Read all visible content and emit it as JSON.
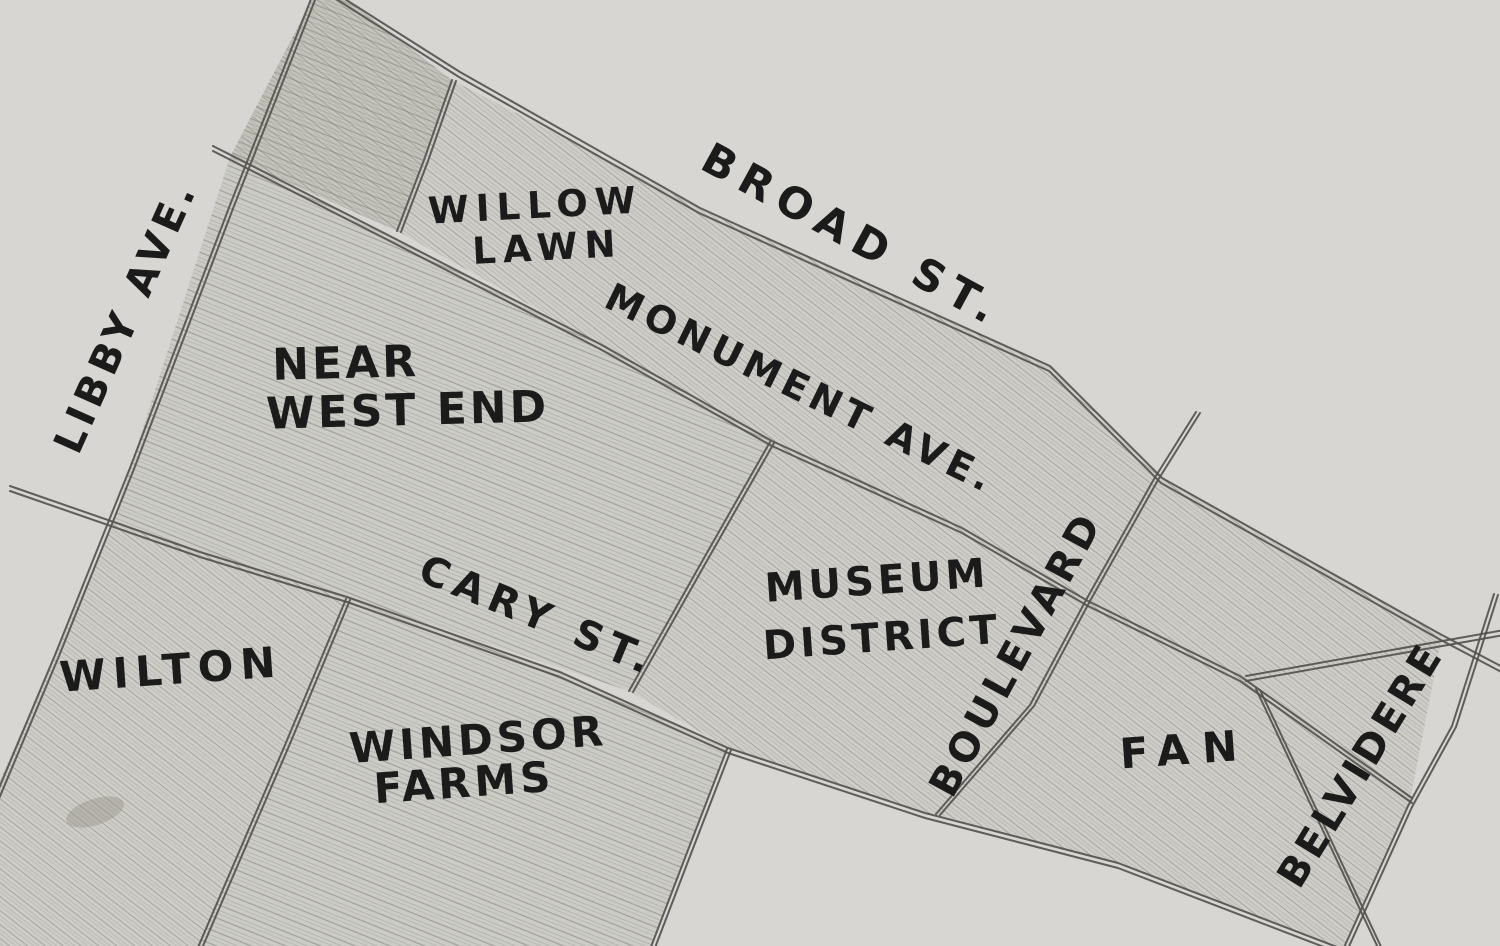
{
  "map": {
    "background_color": "#d7d6d3",
    "ink_color": "#1b1b1b",
    "road_color": "#55534e",
    "hatch_color": "#6f6d60",
    "regions": [
      {
        "id": "willow-lawn",
        "lines": [
          "WILLOW",
          "LAWN"
        ]
      },
      {
        "id": "near-west-end",
        "lines": [
          "NEAR",
          "WEST END"
        ]
      },
      {
        "id": "museum-district",
        "lines": [
          "MUSEUM",
          "DISTRICT"
        ]
      },
      {
        "id": "wilton",
        "lines": [
          "WILTON"
        ]
      },
      {
        "id": "windsor-farms",
        "lines": [
          "WINDSOR",
          "FARMS"
        ]
      },
      {
        "id": "fan",
        "lines": [
          "FAN"
        ]
      }
    ],
    "streets": [
      {
        "id": "libby-ave",
        "label": "LIBBY AVE."
      },
      {
        "id": "broad-st",
        "label": "BROAD ST."
      },
      {
        "id": "monument-ave",
        "label": "MONUMENT AVE."
      },
      {
        "id": "cary-st",
        "label": "CARY ST."
      },
      {
        "id": "boulevard",
        "label": "BOULEVARD"
      },
      {
        "id": "belvidere",
        "label": "BELVIDERE"
      }
    ]
  }
}
